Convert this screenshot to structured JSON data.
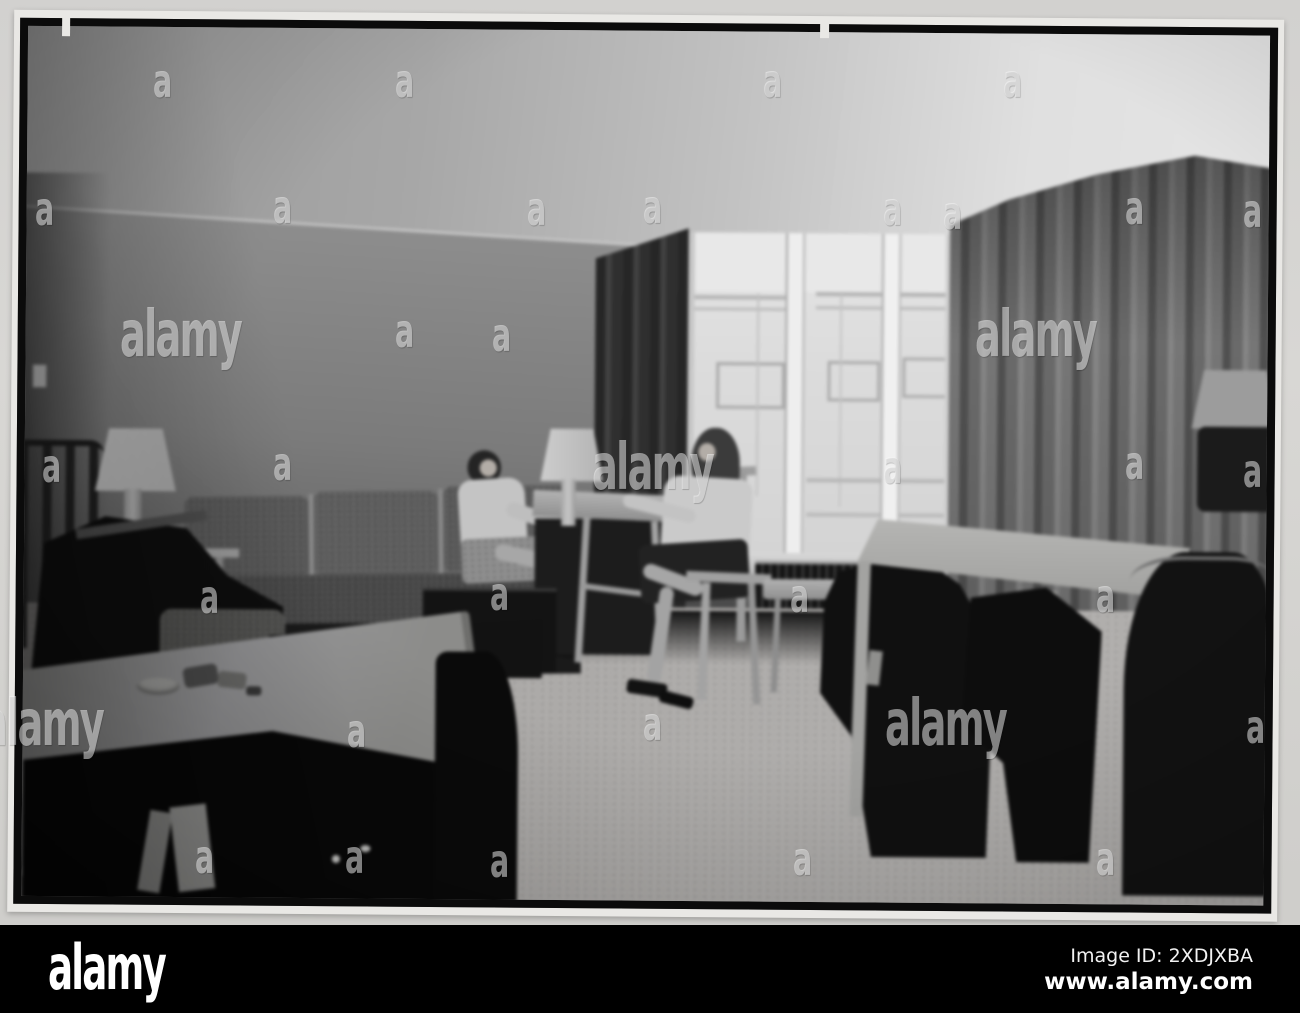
{
  "footer": {
    "brand": "alamy",
    "image_id": "Image ID: 2XDJXBA",
    "website": "www.alamy.com"
  },
  "watermark": {
    "logo": "alamy",
    "tile": "a"
  },
  "photo": {
    "description": "Black-and-white photograph of a mid-century lounge interior: two women seated and talking beside a large window, a long upholstered sofa along the back wall, table lamps, card tables with dark chairs, full-height drapes and a light carpet.",
    "colors": {
      "mount_background": "#d5d4d1",
      "print_border": "#0b0b0b",
      "footer_bar": "#000000",
      "watermark_text": "rgba(250,250,250,0.5)"
    }
  }
}
